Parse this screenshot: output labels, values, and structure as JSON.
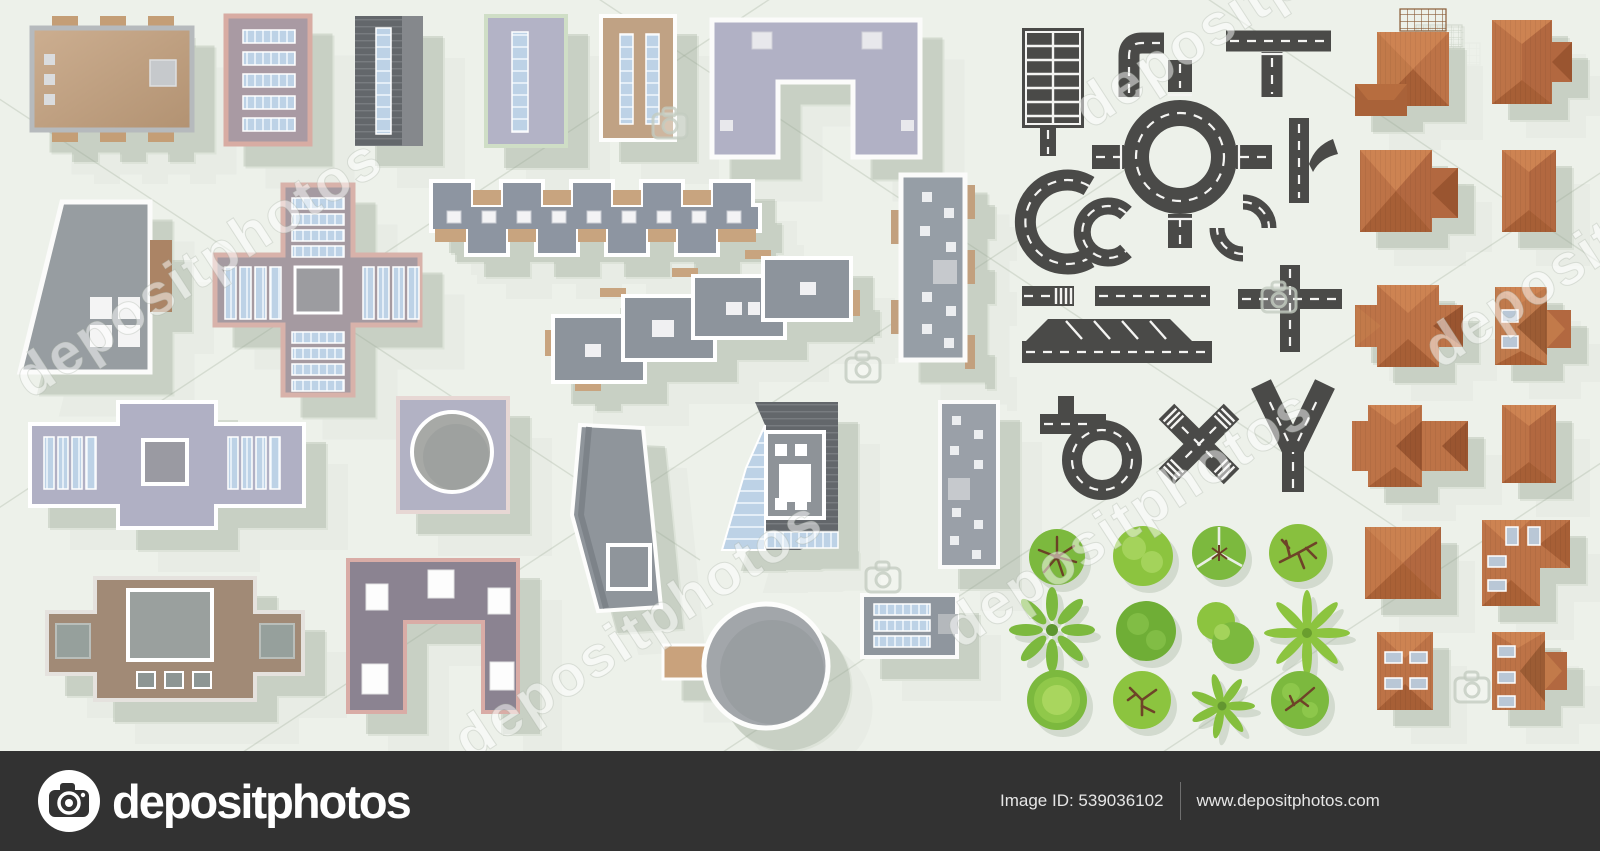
{
  "watermark": {
    "text": "depositphotos",
    "camera_icon": "camera-icon"
  },
  "footer": {
    "brand": "depositphotos",
    "logo_icon": "camera-icon",
    "image_id": "Image ID: 539036102",
    "site": "www.depositphotos.com"
  },
  "palette": {
    "background": "#EDF1EA",
    "footer_bar": "#323232",
    "road_asphalt": "#4A4A48",
    "road_marking": "#F4F4F2",
    "building_grey": "#9AA0A8",
    "building_lavender": "#B1B1C5",
    "building_tan": "#C0A284",
    "trim_pink": "#D8ACA3",
    "glass_blue": "#BDD2E6",
    "roof_terracotta": "#BD7347",
    "roof_shade": "#9A5530",
    "tree_green": "#7CB93E",
    "tree_green_light": "#A4D35B",
    "branch_brown": "#6E4328",
    "shadow": "#DCE3D8"
  },
  "kit": {
    "buildings": [
      "flat-roof-building-tan",
      "apartment-block-pink-trim",
      "dark-roof-skylight-block",
      "lavender-skylight-block",
      "tan-two-skylight-block",
      "arch-courtyard-building",
      "trapezoid-building",
      "cross-plan-building",
      "battlement-row-building",
      "stepped-terrace-building",
      "tall-slab-with-balconies",
      "winged-block-with-skylights",
      "square-hall-round-dome",
      "bent-tower-block",
      "glass-atrium-tower",
      "thin-slab-tower",
      "low-wing-with-skylights",
      "brown-plaza-building",
      "u-plan-building",
      "round-tank-with-annex"
    ],
    "roads": [
      "parking-lot",
      "corner-road",
      "t-junction",
      "roundabout",
      "merge-ramp",
      "large-curve",
      "small-curve",
      "arc-segment-pair",
      "road-with-crosswalk",
      "straight-road",
      "crossroad-intersection",
      "roadside-angled-parking",
      "loop-road",
      "x-intersection-with-crosswalks",
      "y-junction"
    ],
    "trees": [
      "tree-radial-branches",
      "tree-fluffy-light",
      "tree-cracked-canopy",
      "tree-branch-network",
      "tree-star-leaves",
      "tree-dense-dark",
      "tree-double-lobe",
      "palm-tree",
      "tree-concentric",
      "tree-branches-light",
      "palm-small",
      "tree-branches-blotch"
    ],
    "houses": [
      "house-square-hip-pergola",
      "house-gable-extension",
      "house-chevron-extension",
      "house-rect-hip",
      "house-cross-hip",
      "house-skylights-gable",
      "house-double-cross",
      "house-rect-hip-2",
      "house-pyramid",
      "house-l-shaped-skylights",
      "house-four-skylights",
      "house-three-skylights-gable"
    ]
  }
}
